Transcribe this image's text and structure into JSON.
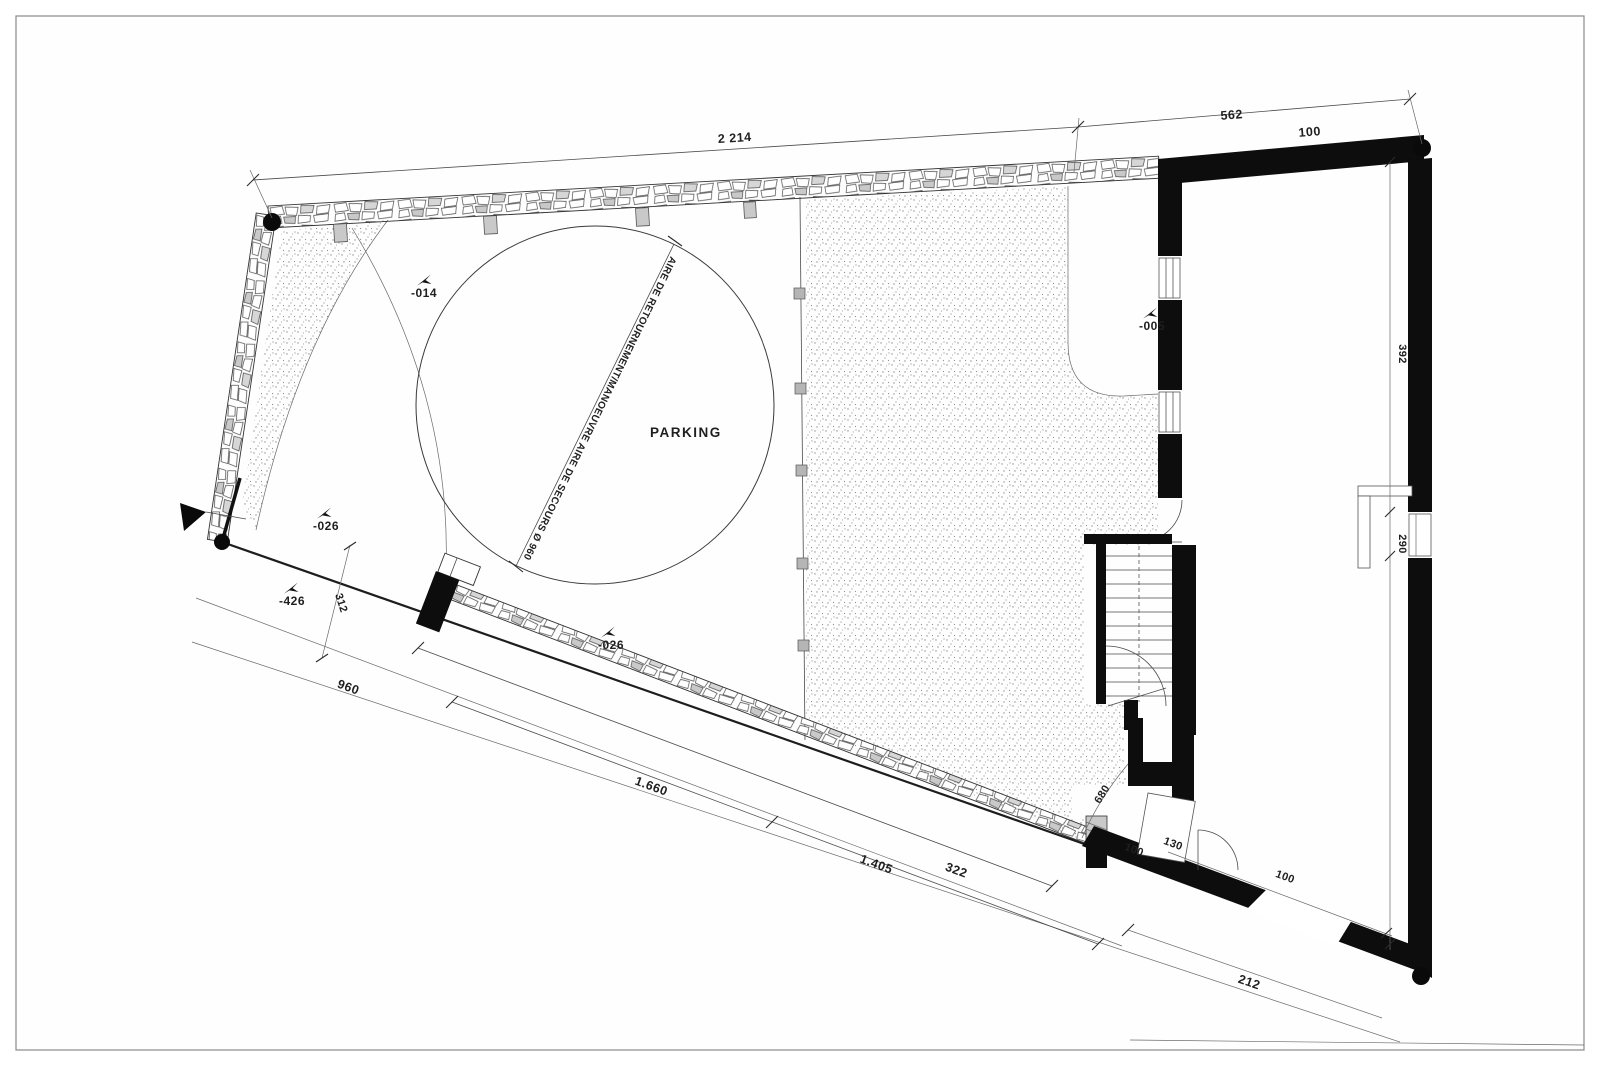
{
  "drawing": {
    "type": "architectural-site-plan",
    "labels": {
      "parking": "PARKING",
      "turning_area": "AIRE DE RETOURNEMENT/MANOEUVRE AIRE DE SECOURS Ø 960"
    },
    "dimensions": {
      "top_main": "2 214",
      "top_secondary": "562",
      "top_wall": "100",
      "side_upper": "392",
      "side_window": "290",
      "gate_offset": "312",
      "road_frontage": "960",
      "bottom_long": "1.660",
      "bottom_mid": "1.405",
      "bottom_short": "322",
      "bottom_right": "212",
      "inner_bottom": "100",
      "inner_left": "100",
      "door_width": "130",
      "diag_leader": "680"
    },
    "level_markers": {
      "courtyard_upper": "-014",
      "entry_path": "-005",
      "gate_inner": "-026",
      "street_level": "-426",
      "parking_edge": "-026"
    },
    "colors": {
      "ink": "#2b2b2b",
      "wall_fill": "#0d0d0d",
      "stipple_dot": "#8f8f8f",
      "stone_gray": "#c9c9c9",
      "frame": "#8a8a8a"
    }
  }
}
